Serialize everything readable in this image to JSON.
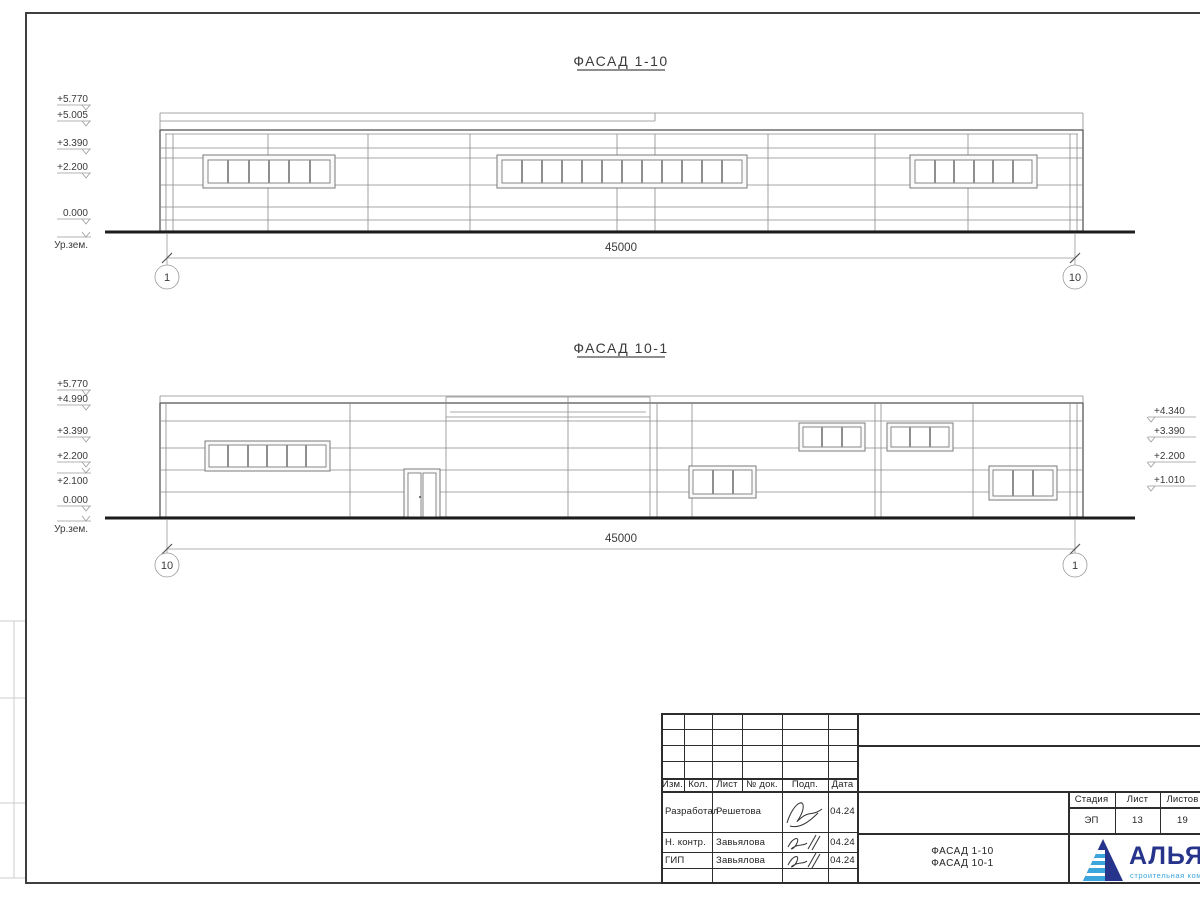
{
  "sheet": {
    "facade1": {
      "title": "ФАСАД 1-10",
      "dim": "45000",
      "axis_left": "1",
      "axis_right": "10",
      "marks_left": [
        "+5.770",
        "+5.005",
        "+3.390",
        "+2.200",
        "0.000",
        "Ур.зем."
      ]
    },
    "facade2": {
      "title": "ФАСАД 10-1",
      "dim": "45000",
      "axis_left": "10",
      "axis_right": "1",
      "marks_left": [
        "+5.770",
        "+4.990",
        "+3.390",
        "+2.200",
        "+2.100",
        "0.000",
        "Ур.зем."
      ],
      "marks_right": [
        "+4.340",
        "+3.390",
        "+2.200",
        "+1.010"
      ]
    },
    "stamp": {
      "cols": [
        "Изм.",
        "Кол.",
        "Лист",
        "№ док.",
        "Подп.",
        "Дата"
      ],
      "rows": [
        {
          "role": "Разработал",
          "name": "Решетова",
          "date": "04.24"
        },
        {
          "role": "Н. контр.",
          "name": "Завьялова",
          "date": "04.24"
        },
        {
          "role": "ГИП",
          "name": "Завьялова",
          "date": "04.24"
        }
      ],
      "stage_label": "Стадия",
      "sheet_label": "Лист",
      "sheets_label": "Листов",
      "stage": "ЭП",
      "sheet_no": "13",
      "sheets_total": "19",
      "title_line1": "ФАСАД 1-10",
      "title_line2": "ФАСАД 10-1",
      "company_name": "АЛЬЯНС",
      "company_tagline": "строительная компания"
    },
    "colors": {
      "logo_navy": "#27348b",
      "logo_blue": "#3aa6dc"
    }
  }
}
